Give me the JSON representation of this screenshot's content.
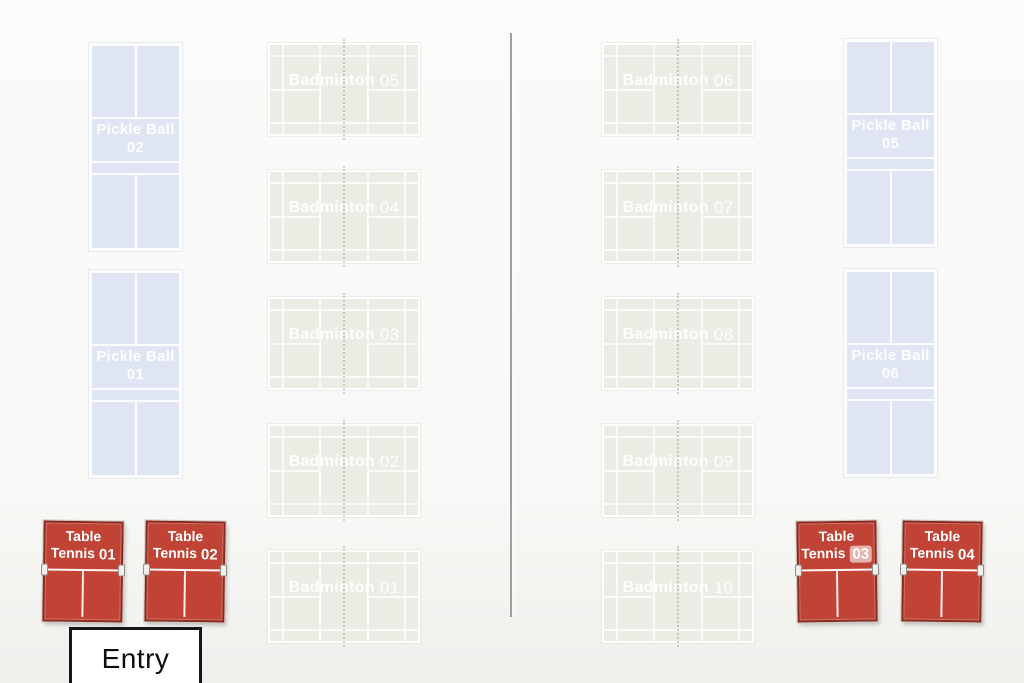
{
  "canvas": {
    "width": 1024,
    "height": 683
  },
  "colors": {
    "badminton_fill": "#e9ede3",
    "pickleball_fill": "#e0e5f4",
    "table_tennis_fill": "#c04335",
    "table_tennis_border": "#8a2b20",
    "court_line": "#ffffff",
    "net_dotted_line": "#a3aa9e",
    "divider_line": "#9f9f9f",
    "entry_border": "#161616",
    "entry_text": "#0d0d0d",
    "label_text": "#ffffff"
  },
  "divider": {
    "orientation": "vertical"
  },
  "entry": {
    "label": "Entry"
  },
  "pickleball_courts": [
    {
      "id": "pickle-ball-court-02",
      "name": "Pickle Ball",
      "number": "02",
      "x": 89,
      "y": 43
    },
    {
      "id": "pickle-ball-court-01",
      "name": "Pickle Ball",
      "number": "01",
      "x": 89,
      "y": 270
    },
    {
      "id": "pickle-ball-court-05",
      "name": "Pickle Ball",
      "number": "05",
      "x": 844,
      "y": 39
    },
    {
      "id": "pickle-ball-court-06",
      "name": "Pickle Ball",
      "number": "06",
      "x": 844,
      "y": 269
    }
  ],
  "badminton_courts": [
    {
      "id": "badminton-court-05",
      "name": "Badminton",
      "number": "05",
      "x": 268,
      "y": 43
    },
    {
      "id": "badminton-court-04",
      "name": "Badminton",
      "number": "04",
      "x": 268,
      "y": 170
    },
    {
      "id": "badminton-court-03",
      "name": "Badminton",
      "number": "03",
      "x": 268,
      "y": 297
    },
    {
      "id": "badminton-court-02",
      "name": "Badminton",
      "number": "02",
      "x": 268,
      "y": 424
    },
    {
      "id": "badminton-court-01",
      "name": "Badminton",
      "number": "01",
      "x": 268,
      "y": 550
    },
    {
      "id": "badminton-court-06",
      "name": "Badminton",
      "number": "06",
      "x": 602,
      "y": 43
    },
    {
      "id": "badminton-court-07",
      "name": "Badminton",
      "number": "07",
      "x": 602,
      "y": 170
    },
    {
      "id": "badminton-court-08",
      "name": "Badminton",
      "number": "08",
      "x": 602,
      "y": 297
    },
    {
      "id": "badminton-court-09",
      "name": "Badminton",
      "number": "09",
      "x": 602,
      "y": 424
    },
    {
      "id": "badminton-court-10",
      "name": "Badminton",
      "number": "10",
      "x": 602,
      "y": 550
    }
  ],
  "table_tennis_tables": [
    {
      "id": "table-tennis-01",
      "line1": "Table",
      "line2": "Tennis",
      "number": "01",
      "x": 43,
      "y": 521,
      "tilt": 0.8,
      "highlighted": false
    },
    {
      "id": "table-tennis-02",
      "line1": "Table",
      "line2": "Tennis",
      "number": "02",
      "x": 145,
      "y": 521,
      "tilt": 0.8,
      "highlighted": false
    },
    {
      "id": "table-tennis-03",
      "line1": "Table",
      "line2": "Tennis",
      "number": "03",
      "x": 797,
      "y": 521,
      "tilt": -0.8,
      "highlighted": true
    },
    {
      "id": "table-tennis-04",
      "line1": "Table",
      "line2": "Tennis",
      "number": "04",
      "x": 902,
      "y": 521,
      "tilt": 0.8,
      "highlighted": false
    }
  ]
}
